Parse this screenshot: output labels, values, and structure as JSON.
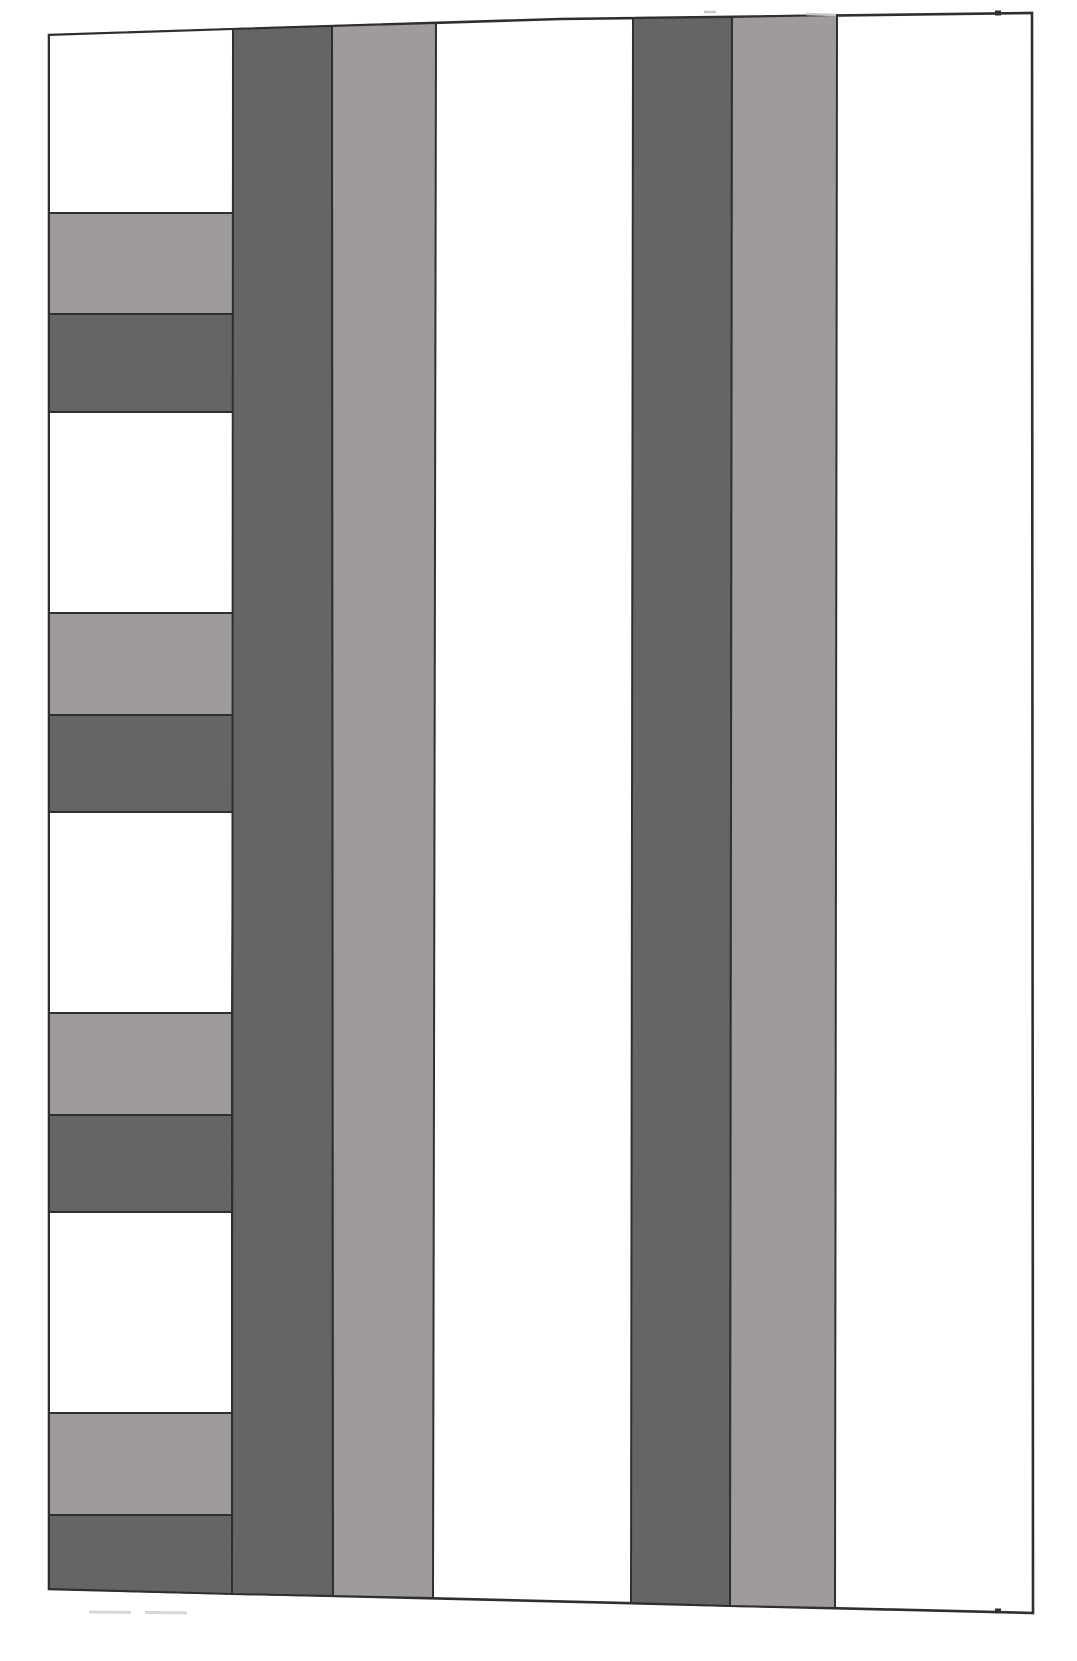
{
  "figure": {
    "palette": {
      "white": "#ffffff",
      "light_gray": "#9f9b9a",
      "dark_gray": "#656565",
      "outline": "#2f2f2f",
      "faint": "#d8d5d4",
      "faint_light": "#c9c6c5"
    },
    "canvas": {
      "width": 1077,
      "height": 1661,
      "background": "#ffffff"
    },
    "shapes": [
      {
        "name": "outer-panel",
        "fill": "white",
        "stroke": "outline",
        "stroke_width": 2.6,
        "points": [
          [
            49,
            35
          ],
          [
            560,
            19
          ],
          [
            1032,
            13
          ],
          [
            1033,
            1613
          ],
          [
            49,
            1589
          ]
        ]
      },
      {
        "name": "left-column-band-1-white",
        "fill": "white",
        "stroke": "outline",
        "stroke_width": 2,
        "points": [
          [
            49,
            35
          ],
          [
            233,
            29
          ],
          [
            233,
            213
          ],
          [
            49,
            213
          ]
        ]
      },
      {
        "name": "left-column-band-2-light",
        "fill": "light_gray",
        "stroke": "outline",
        "stroke_width": 2,
        "points": [
          [
            49,
            213
          ],
          [
            233,
            213
          ],
          [
            233,
            314
          ],
          [
            49,
            314
          ]
        ]
      },
      {
        "name": "left-column-band-3-dark",
        "fill": "dark_gray",
        "stroke": "outline",
        "stroke_width": 2,
        "points": [
          [
            49,
            314
          ],
          [
            233,
            314
          ],
          [
            233,
            412
          ],
          [
            49,
            412
          ]
        ]
      },
      {
        "name": "left-column-band-4-white",
        "fill": "white",
        "stroke": "outline",
        "stroke_width": 2,
        "points": [
          [
            49,
            412
          ],
          [
            233,
            412
          ],
          [
            233,
            613
          ],
          [
            49,
            613
          ]
        ]
      },
      {
        "name": "left-column-band-5-light",
        "fill": "light_gray",
        "stroke": "outline",
        "stroke_width": 2,
        "points": [
          [
            49,
            613
          ],
          [
            233,
            613
          ],
          [
            233,
            715
          ],
          [
            49,
            715
          ]
        ]
      },
      {
        "name": "left-column-band-6-dark",
        "fill": "dark_gray",
        "stroke": "outline",
        "stroke_width": 2,
        "points": [
          [
            49,
            715
          ],
          [
            233,
            715
          ],
          [
            233,
            812
          ],
          [
            49,
            812
          ]
        ]
      },
      {
        "name": "left-column-band-7-white",
        "fill": "white",
        "stroke": "outline",
        "stroke_width": 2,
        "points": [
          [
            49,
            812
          ],
          [
            233,
            812
          ],
          [
            232,
            1013
          ],
          [
            49,
            1013
          ]
        ]
      },
      {
        "name": "left-column-band-8-light",
        "fill": "light_gray",
        "stroke": "outline",
        "stroke_width": 2,
        "points": [
          [
            49,
            1013
          ],
          [
            232,
            1013
          ],
          [
            232,
            1115
          ],
          [
            49,
            1115
          ]
        ]
      },
      {
        "name": "left-column-band-9-dark",
        "fill": "dark_gray",
        "stroke": "outline",
        "stroke_width": 2,
        "points": [
          [
            49,
            1115
          ],
          [
            232,
            1115
          ],
          [
            232,
            1212
          ],
          [
            49,
            1212
          ]
        ]
      },
      {
        "name": "left-column-band-10-white",
        "fill": "white",
        "stroke": "outline",
        "stroke_width": 2,
        "points": [
          [
            49,
            1212
          ],
          [
            232,
            1212
          ],
          [
            232,
            1413
          ],
          [
            49,
            1413
          ]
        ]
      },
      {
        "name": "left-column-band-11-light",
        "fill": "light_gray",
        "stroke": "outline",
        "stroke_width": 2,
        "points": [
          [
            49,
            1413
          ],
          [
            232,
            1413
          ],
          [
            232,
            1515
          ],
          [
            49,
            1515
          ]
        ]
      },
      {
        "name": "left-column-band-12-dark",
        "fill": "dark_gray",
        "stroke": "outline",
        "stroke_width": 2,
        "points": [
          [
            49,
            1515
          ],
          [
            232,
            1515
          ],
          [
            232,
            1594
          ],
          [
            49,
            1589
          ]
        ]
      },
      {
        "name": "vertical-stripe-1-dark",
        "fill": "dark_gray",
        "stroke": "outline",
        "stroke_width": 2,
        "points": [
          [
            233,
            29
          ],
          [
            332,
            26
          ],
          [
            333,
            1596
          ],
          [
            232,
            1594
          ]
        ]
      },
      {
        "name": "vertical-stripe-2-light",
        "fill": "light_gray",
        "stroke": "outline",
        "stroke_width": 2,
        "points": [
          [
            332,
            26
          ],
          [
            436,
            23
          ],
          [
            433,
            1598
          ],
          [
            333,
            1596
          ]
        ]
      },
      {
        "name": "vertical-stripe-3-dark",
        "fill": "dark_gray",
        "stroke": "outline",
        "stroke_width": 2,
        "points": [
          [
            633,
            18
          ],
          [
            732,
            17
          ],
          [
            730,
            1606
          ],
          [
            631,
            1603
          ]
        ]
      },
      {
        "name": "vertical-stripe-4-light",
        "fill": "light_gray",
        "stroke": "outline",
        "stroke_width": 2,
        "points": [
          [
            732,
            17
          ],
          [
            837,
            15
          ],
          [
            835,
            1608
          ],
          [
            730,
            1606
          ]
        ]
      }
    ],
    "marks": [
      {
        "name": "bottom-faint-dashed-mark",
        "color": "faint",
        "width": 3,
        "dash": "42 14",
        "x1": 89,
        "y1": 1612,
        "x2": 200,
        "y2": 1613
      },
      {
        "name": "top-faint-mark-1",
        "color": "faint_light",
        "width": 2.5,
        "dash": "",
        "x1": 704,
        "y1": 12,
        "x2": 716,
        "y2": 12
      },
      {
        "name": "top-faint-mark-2",
        "color": "faint_light",
        "width": 2.5,
        "dash": "",
        "x1": 806,
        "y1": 14,
        "x2": 836,
        "y2": 15
      },
      {
        "name": "top-edge-tick",
        "color": "outline",
        "width": 5,
        "dash": "",
        "x1": 995,
        "y1": 13,
        "x2": 1001,
        "y2": 13
      },
      {
        "name": "bottom-edge-tick",
        "color": "outline",
        "width": 5,
        "dash": "",
        "x1": 995,
        "y1": 1611,
        "x2": 1001,
        "y2": 1611
      }
    ]
  }
}
